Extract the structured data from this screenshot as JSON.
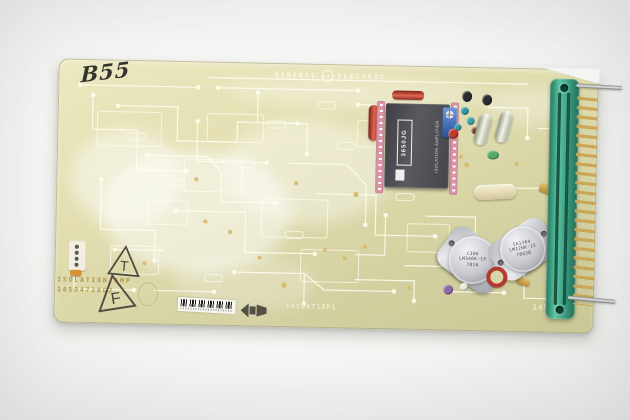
{
  "photo": {
    "subject": "General Electric isolation amplifier circuit board on white backdrop",
    "handwritten_label": "B55"
  },
  "silkscreen": {
    "brand_word1": "GENERAL",
    "brand_word2": "ELECTRIC",
    "ge_monogram": "GE",
    "function_label": "ISOLATION AMP",
    "group_number": "145D4720G2",
    "part_number": "145D4718P1",
    "corner_number": "1450"
  },
  "stamps": {
    "triangle_t": "T",
    "triangle_f": "F"
  },
  "components": {
    "isolation_module": {
      "part_number": "3650JG",
      "type_label": "ISOLATION AMPLIFIER"
    },
    "regulator_left": {
      "line1": "C306",
      "line2": "LM340K-15",
      "line3": "7816"
    },
    "regulator_right": {
      "line1": "SA1364",
      "line2": "LM120K-15",
      "line3": "7803B"
    }
  },
  "colors": {
    "board_base": "#ddd8a9",
    "connector_green": "#3da387",
    "pin_gold": "#c7a452",
    "module_gray": "#4b4a50",
    "socket_pink": "#d794a6",
    "capacitor_red": "#a93226",
    "trimpot_blue": "#4d7fc4",
    "can_silver": "#c9cace"
  }
}
